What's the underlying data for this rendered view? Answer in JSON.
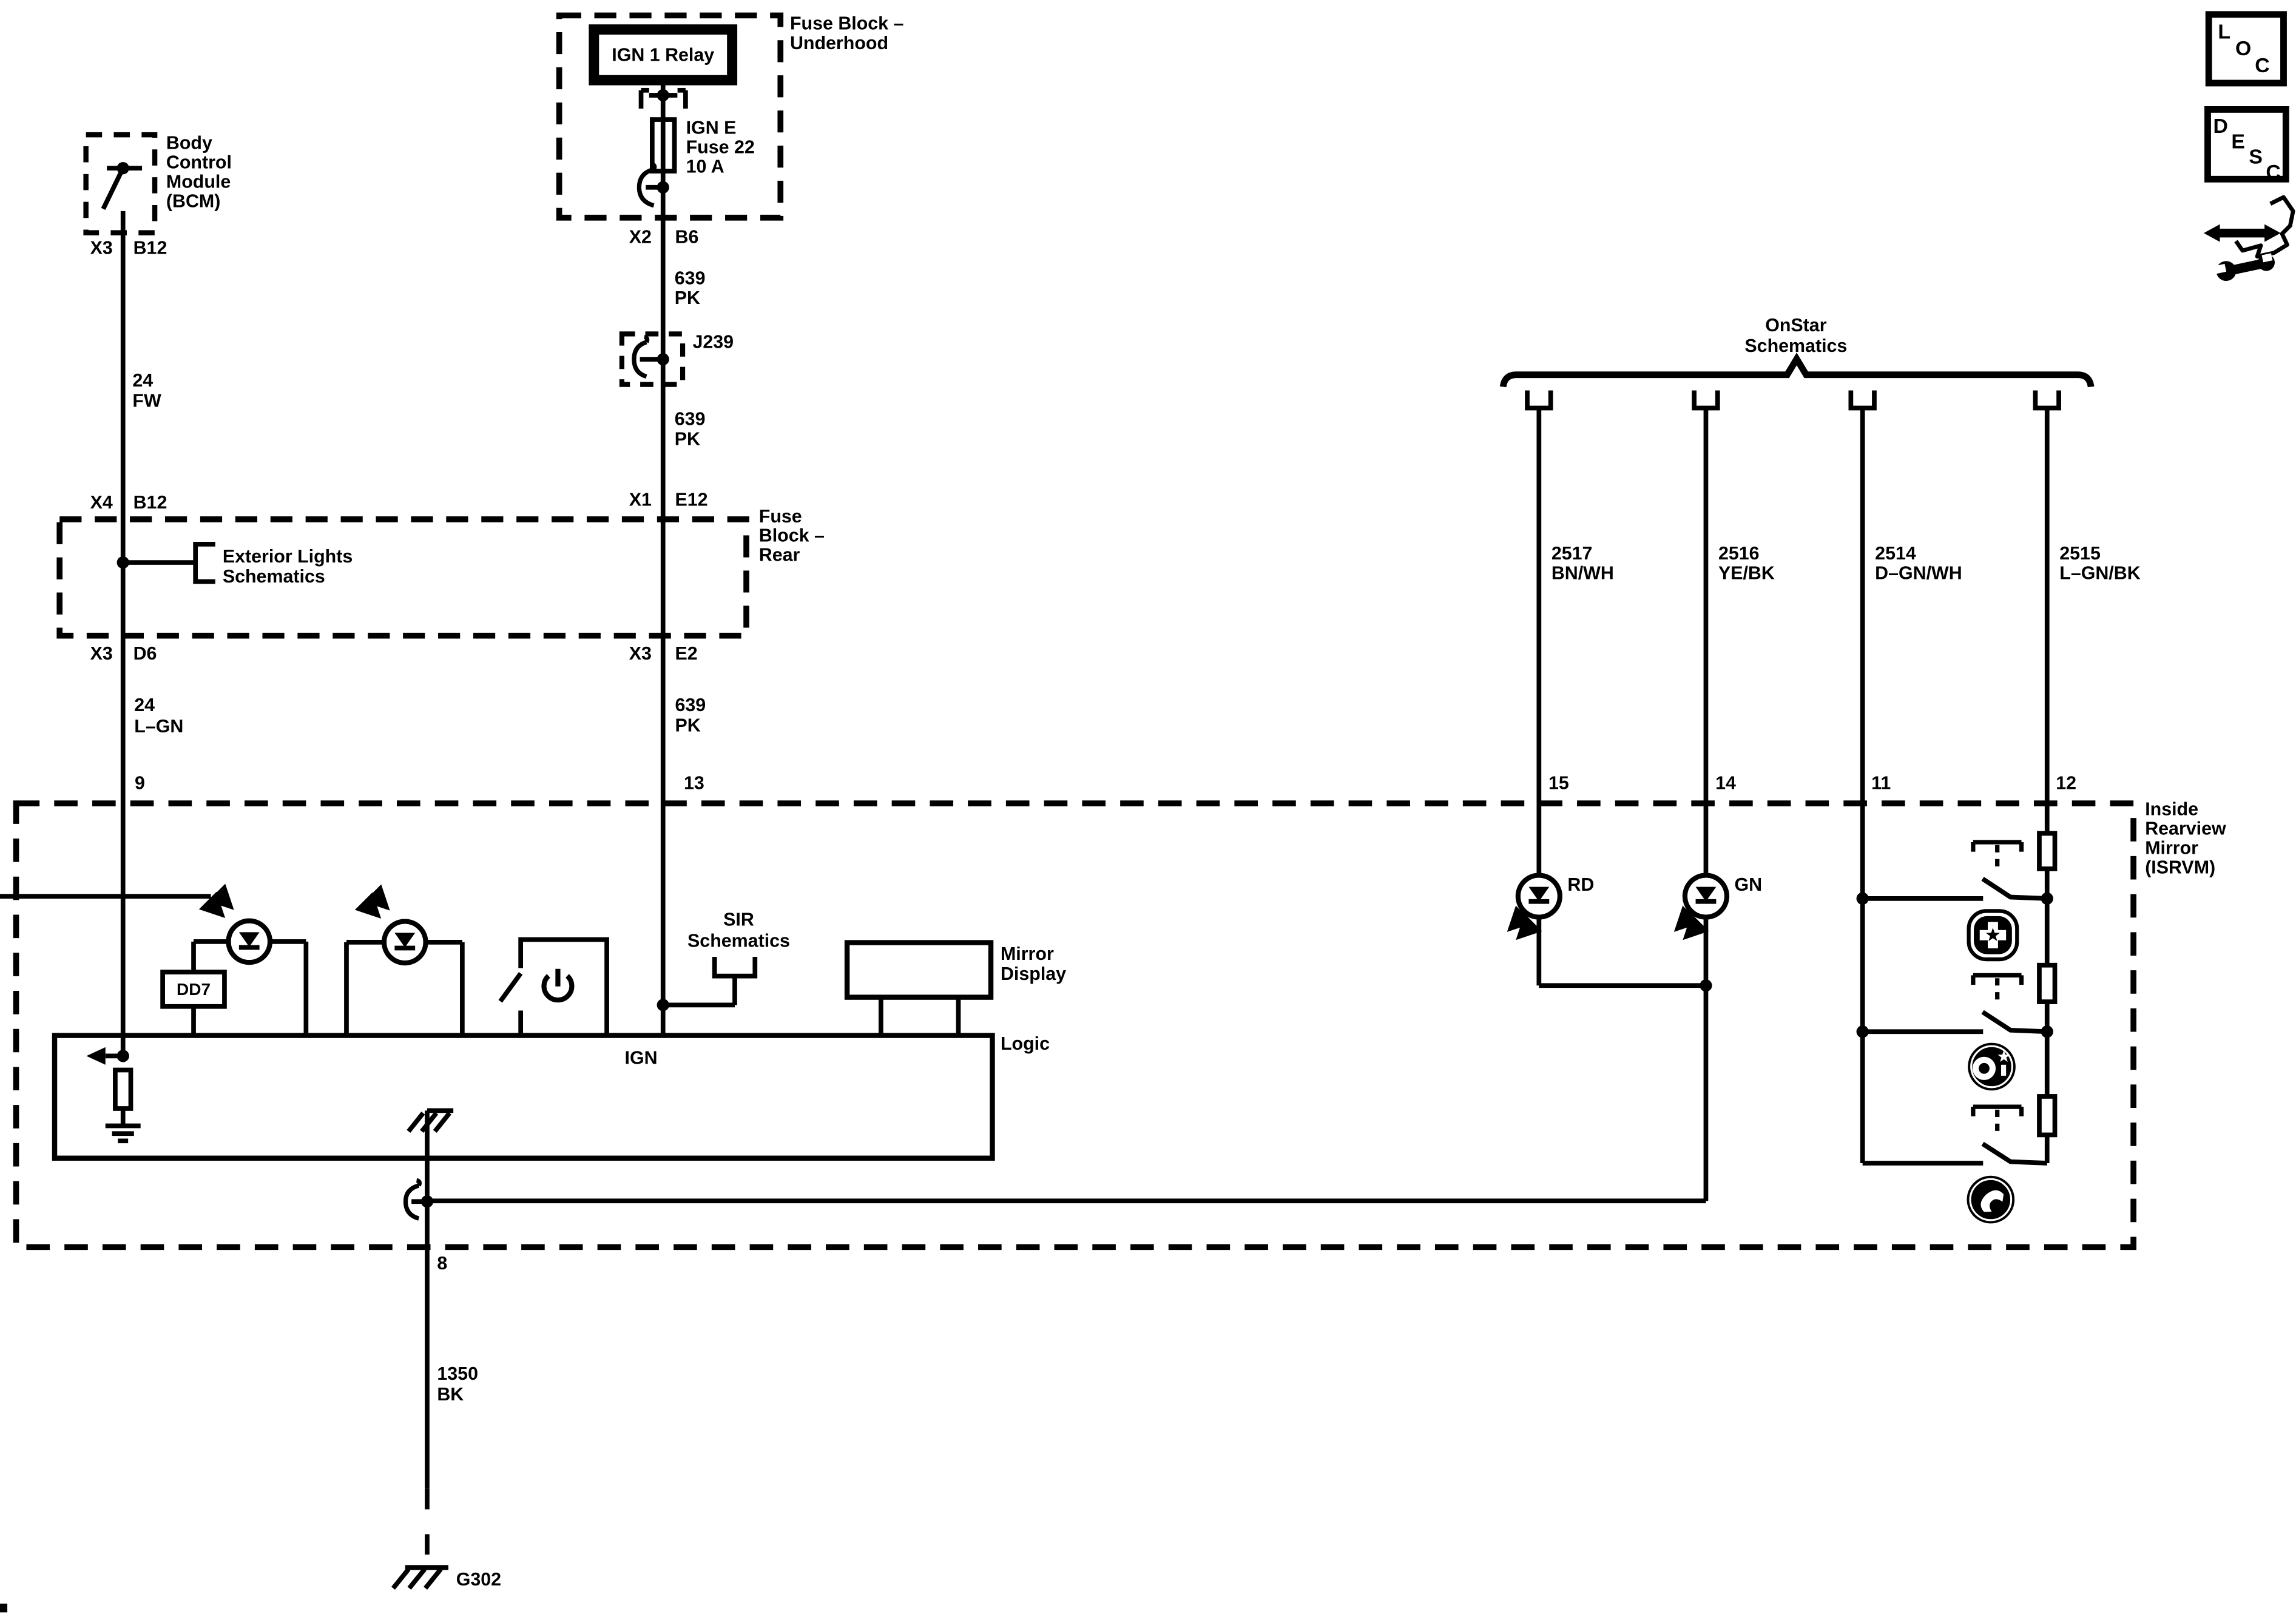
{
  "diagram": {
    "bcm": {
      "title": [
        "Body",
        "Control",
        "Module",
        "(BCM)"
      ],
      "conn_left": "X3",
      "conn_right": "B12"
    },
    "left_branch": {
      "wire1": [
        "24",
        "FW"
      ],
      "x4": "X4",
      "b12": "B12",
      "x3": "X3",
      "d6": "D6",
      "wire2": [
        "24",
        "L–GN"
      ],
      "pin": "9"
    },
    "underhood": {
      "title": [
        "Fuse Block –",
        "Underhood"
      ],
      "relay": "IGN 1 Relay",
      "fuse": [
        "IGN E",
        "Fuse 22",
        "10 A"
      ],
      "conn_left": "X2",
      "conn_right": "B6"
    },
    "center_branch": {
      "wire1": [
        "639",
        "PK"
      ],
      "splice": "J239",
      "wire2": [
        "639",
        "PK"
      ],
      "x1": "X1",
      "e12": "E12",
      "x3": "X3",
      "e2": "E2",
      "wire3": [
        "639",
        "PK"
      ],
      "pin": "13",
      "ign": "IGN"
    },
    "rear_block": {
      "title": [
        "Fuse",
        "Block –",
        "Rear"
      ],
      "exterior": [
        "Exterior Lights",
        "Schematics"
      ]
    },
    "onstar": {
      "title": [
        "OnStar",
        "Schematics"
      ],
      "wires": [
        {
          "id": "2517",
          "color": "BN/WH",
          "pin": "15",
          "led": "RD"
        },
        {
          "id": "2516",
          "color": "YE/BK",
          "pin": "14",
          "led": "GN"
        },
        {
          "id": "2514",
          "color": "D–GN/WH",
          "pin": "11"
        },
        {
          "id": "2515",
          "color": "L–GN/BK",
          "pin": "12"
        }
      ]
    },
    "isrvm": {
      "title": [
        "Inside",
        "Rearview",
        "Mirror",
        "(ISRVM)"
      ],
      "dd7": "DD7",
      "sir": [
        "SIR",
        "Schematics"
      ],
      "display": [
        "Mirror",
        "Display"
      ],
      "logic": "Logic",
      "pin8": "8",
      "gnd_wire": [
        "1350",
        "BK"
      ],
      "ground": "G302"
    },
    "corner": {
      "loc": [
        "L",
        "O",
        "C"
      ],
      "desc": [
        "D",
        "E",
        "S",
        "C"
      ]
    },
    "colors": {
      "ink": "#000000",
      "paper": "#ffffff"
    }
  }
}
